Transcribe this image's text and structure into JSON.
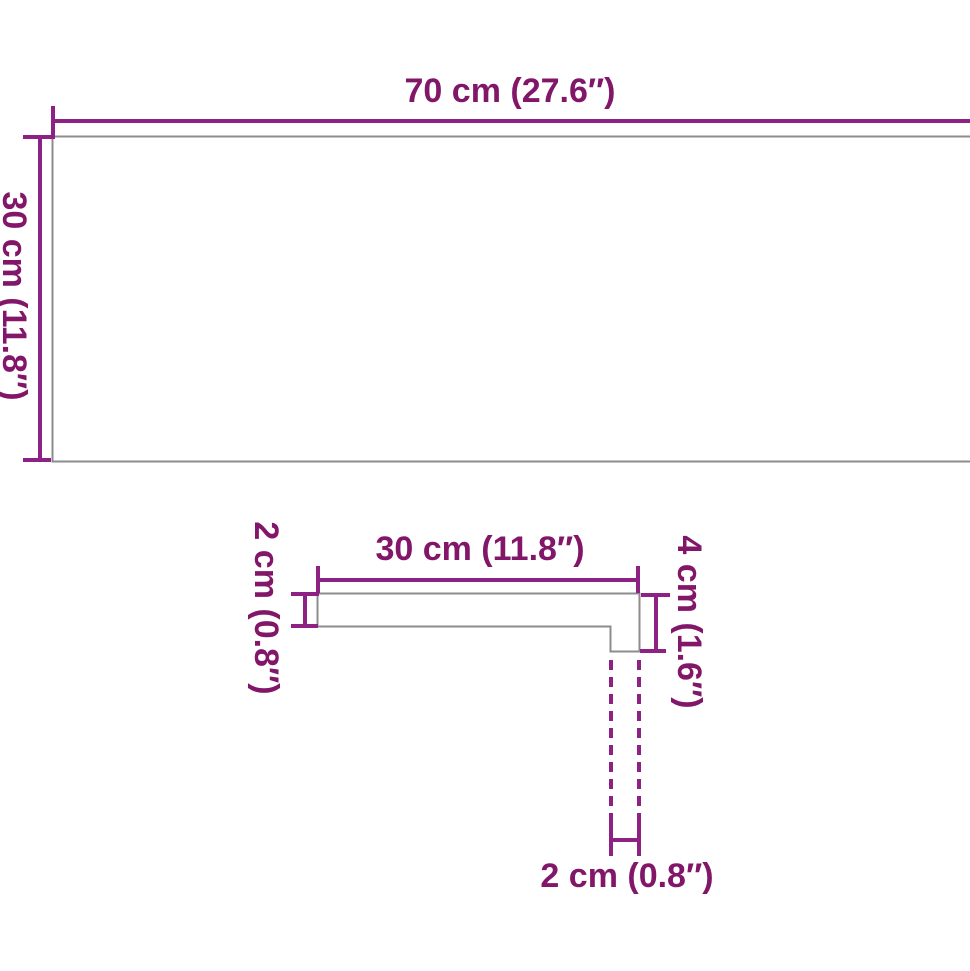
{
  "diagram": {
    "type": "product-dimension-drawing",
    "colors": {
      "dimension": "#8e2184",
      "text": "#821669",
      "outline": "#8c8c8c",
      "background": "#ffffff"
    },
    "top_view": {
      "width_label": "70 cm (27.6″)",
      "depth_label": "30 cm (11.8″)"
    },
    "side_profile": {
      "top_width_label": "30 cm (11.8″)",
      "left_thickness_label": "2 cm (0.8″)",
      "right_height_label": "4 cm (1.6″)",
      "bottom_nose_label": "2 cm (0.8″)"
    }
  }
}
